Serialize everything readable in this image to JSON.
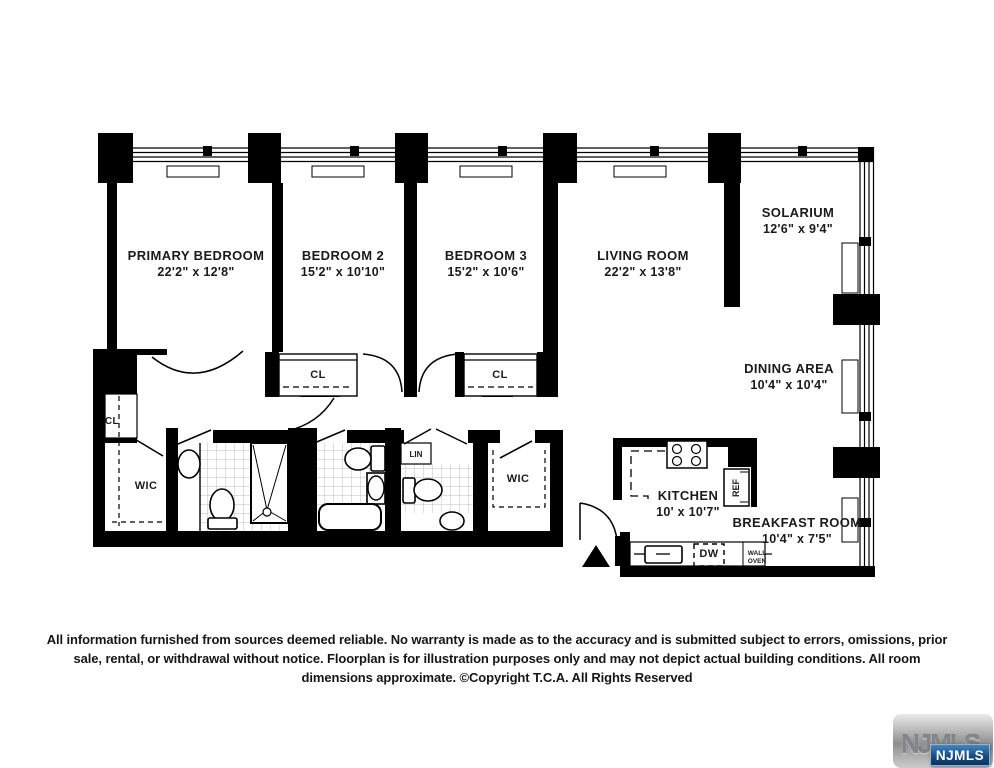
{
  "floorplan": {
    "rooms": [
      {
        "id": "primary-bedroom",
        "name": "PRIMARY BEDROOM",
        "dims": "22'2\" x 12'8\""
      },
      {
        "id": "bedroom-2",
        "name": "BEDROOM 2",
        "dims": "15'2\" x 10'10\""
      },
      {
        "id": "bedroom-3",
        "name": "BEDROOM 3",
        "dims": "15'2\" x 10'6\""
      },
      {
        "id": "living-room",
        "name": "LIVING ROOM",
        "dims": "22'2\" x 13'8\""
      },
      {
        "id": "solarium",
        "name": "SOLARIUM",
        "dims": "12'6\" x 9'4\""
      },
      {
        "id": "dining-area",
        "name": "DINING AREA",
        "dims": "10'4\" x 10'4\""
      },
      {
        "id": "kitchen",
        "name": "KITCHEN",
        "dims": "10' x 10'7\""
      },
      {
        "id": "breakfast-room",
        "name": "BREAKFAST ROOM",
        "dims": "10'4\" x 7'5\""
      }
    ],
    "closets": {
      "primary_wic": "WIC",
      "hall_wic": "WIC",
      "bedroom2_closet": "CL",
      "bedroom3_closet": "CL",
      "primary_closet": "CL",
      "linen": "LIN"
    },
    "appliances": {
      "refrigerator": "REF",
      "dishwasher": "DW",
      "wall_oven_line1": "WALL",
      "wall_oven_line2": "OVEN"
    }
  },
  "disclaimer": "All information furnished from sources deemed reliable. No warranty is made as to the accuracy and is submitted subject to errors, omissions, prior sale, rental, or withdrawal without notice. Floorplan is for illustration purposes only and may not depict actual building conditions. All room dimensions approximate.  ©Copyright T.C.A. All Rights Reserved",
  "logo": {
    "watermark": "NJMLS",
    "badge": "NJMLS"
  }
}
